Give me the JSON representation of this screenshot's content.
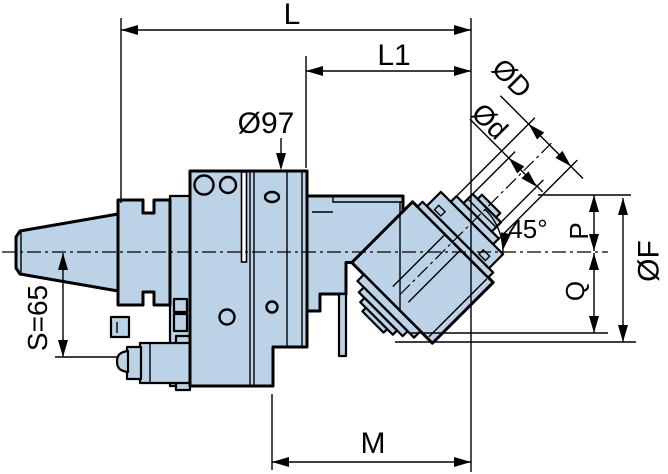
{
  "drawing": {
    "subject": "45-degree angle head tool holder dimension drawing",
    "body_fill": "#bcd2e6",
    "line_color": "#000000",
    "background": "#ffffff"
  },
  "labels": {
    "L": "L",
    "L1": "L1",
    "dia97": "Ø97",
    "diaD": "ØD",
    "diad": "Ød",
    "angle45": "45°",
    "P": "P",
    "Q": "Q",
    "diaF": "ØF",
    "S": "S=65",
    "M": "M"
  }
}
